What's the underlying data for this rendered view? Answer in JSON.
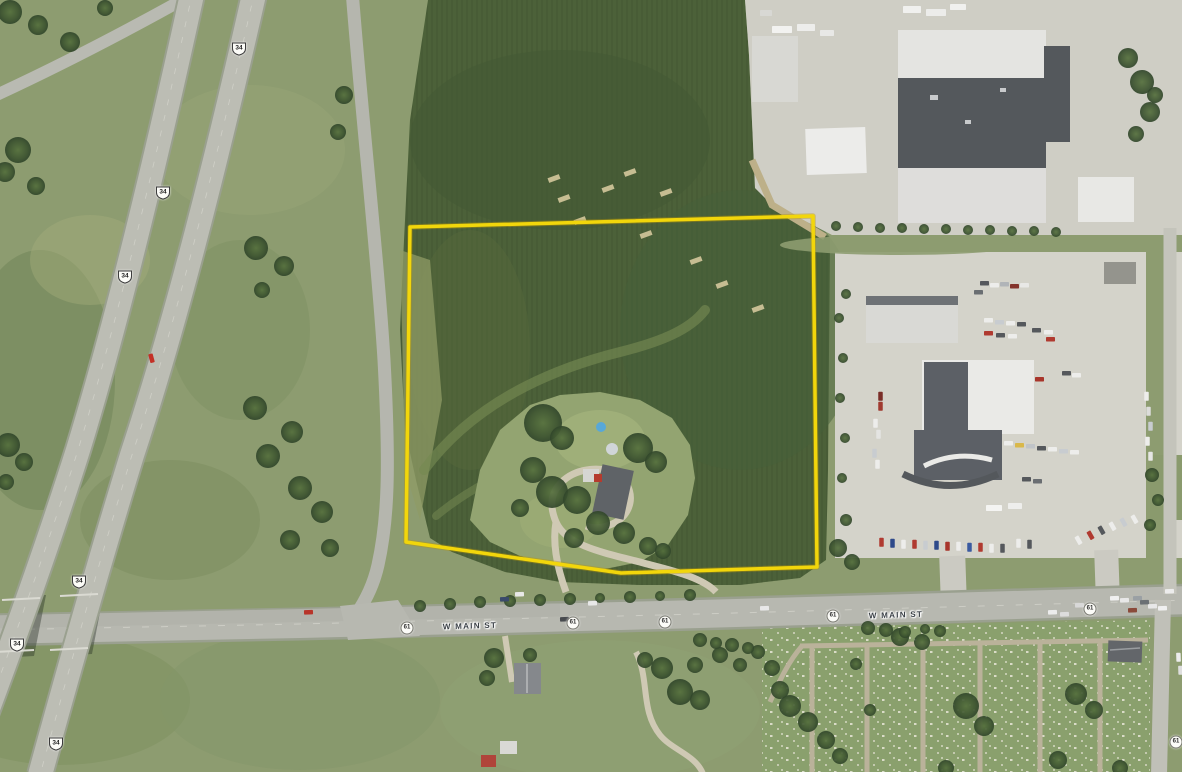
{
  "map": {
    "type": "aerial-imagery-with-parcel-overlay",
    "boundary": {
      "points": "410,227 813,216 817,567 621,573 406,542",
      "color": "#f2d60b"
    },
    "road_labels": [
      {
        "text": "W MAIN ST",
        "x": 470,
        "y": 626
      },
      {
        "text": "W MAIN ST",
        "x": 896,
        "y": 615
      }
    ],
    "us_route_shields": [
      {
        "label": "34",
        "x": 239,
        "y": 49
      },
      {
        "label": "34",
        "x": 163,
        "y": 193
      },
      {
        "label": "34",
        "x": 125,
        "y": 277
      },
      {
        "label": "34",
        "x": 79,
        "y": 582
      },
      {
        "label": "34",
        "x": 17,
        "y": 645
      },
      {
        "label": "34",
        "x": 56,
        "y": 744
      }
    ],
    "circle_route_shields": [
      {
        "label": "61",
        "x": 407,
        "y": 628
      },
      {
        "label": "61",
        "x": 573,
        "y": 623
      },
      {
        "label": "61",
        "x": 665,
        "y": 622
      },
      {
        "label": "61",
        "x": 833,
        "y": 616
      },
      {
        "label": "61",
        "x": 1090,
        "y": 609
      },
      {
        "label": "61",
        "x": 1176,
        "y": 742
      }
    ],
    "colors": {
      "field_dark": "#4c6139",
      "grass": "#8d9c70",
      "pavement": "#cfcec5",
      "road": "#b7b8b0",
      "boundary_yellow": "#f2d60b"
    }
  },
  "scene": {
    "trees": [
      [
        10,
        12,
        12
      ],
      [
        38,
        25,
        10
      ],
      [
        70,
        42,
        10
      ],
      [
        105,
        8,
        8
      ],
      [
        18,
        150,
        13
      ],
      [
        5,
        172,
        10
      ],
      [
        36,
        186,
        9
      ],
      [
        8,
        445,
        12
      ],
      [
        24,
        462,
        9
      ],
      [
        6,
        482,
        8
      ],
      [
        256,
        248,
        12
      ],
      [
        284,
        266,
        10
      ],
      [
        262,
        290,
        8
      ],
      [
        255,
        408,
        12
      ],
      [
        292,
        432,
        11
      ],
      [
        268,
        456,
        12
      ],
      [
        300,
        488,
        12
      ],
      [
        322,
        512,
        11
      ],
      [
        290,
        540,
        10
      ],
      [
        330,
        548,
        9
      ],
      [
        344,
        95,
        9
      ],
      [
        338,
        132,
        8
      ],
      [
        543,
        423,
        19
      ],
      [
        562,
        438,
        12
      ],
      [
        533,
        470,
        13
      ],
      [
        552,
        492,
        16
      ],
      [
        577,
        500,
        14
      ],
      [
        598,
        523,
        12
      ],
      [
        574,
        538,
        10
      ],
      [
        638,
        448,
        15
      ],
      [
        656,
        462,
        11
      ],
      [
        624,
        533,
        11
      ],
      [
        648,
        546,
        9
      ],
      [
        663,
        551,
        8
      ],
      [
        520,
        508,
        9
      ],
      [
        662,
        668,
        11
      ],
      [
        645,
        660,
        8
      ],
      [
        680,
        692,
        13
      ],
      [
        700,
        700,
        10
      ],
      [
        695,
        665,
        8
      ],
      [
        720,
        655,
        8
      ],
      [
        740,
        665,
        7
      ],
      [
        758,
        652,
        7
      ],
      [
        772,
        668,
        8
      ],
      [
        780,
        690,
        9
      ],
      [
        790,
        706,
        11
      ],
      [
        808,
        722,
        10
      ],
      [
        826,
        740,
        9
      ],
      [
        840,
        756,
        8
      ],
      [
        494,
        658,
        10
      ],
      [
        487,
        678,
        8
      ],
      [
        530,
        655,
        7
      ],
      [
        900,
        637,
        9
      ],
      [
        922,
        642,
        8
      ],
      [
        966,
        706,
        13
      ],
      [
        984,
        726,
        10
      ],
      [
        946,
        768,
        8
      ],
      [
        870,
        710,
        6
      ],
      [
        1058,
        760,
        9
      ],
      [
        1076,
        694,
        11
      ],
      [
        1094,
        710,
        9
      ],
      [
        1120,
        768,
        8
      ],
      [
        856,
        664,
        6
      ],
      [
        1128,
        58,
        10
      ],
      [
        1142,
        82,
        12
      ],
      [
        1150,
        112,
        10
      ],
      [
        1136,
        134,
        8
      ],
      [
        1155,
        95,
        8
      ],
      [
        420,
        606,
        6
      ],
      [
        450,
        604,
        6
      ],
      [
        480,
        602,
        6
      ],
      [
        510,
        601,
        6
      ],
      [
        540,
        600,
        6
      ],
      [
        570,
        599,
        6
      ],
      [
        600,
        598,
        5
      ],
      [
        630,
        597,
        6
      ],
      [
        660,
        596,
        5
      ],
      [
        690,
        595,
        6
      ],
      [
        868,
        628,
        7
      ],
      [
        886,
        630,
        7
      ],
      [
        905,
        632,
        6
      ],
      [
        925,
        629,
        5
      ],
      [
        940,
        631,
        6
      ],
      [
        700,
        640,
        7
      ],
      [
        716,
        643,
        6
      ],
      [
        732,
        645,
        7
      ],
      [
        748,
        648,
        6
      ],
      [
        836,
        226,
        5
      ],
      [
        858,
        227,
        5
      ],
      [
        880,
        228,
        5
      ],
      [
        902,
        228,
        5
      ],
      [
        924,
        229,
        5
      ],
      [
        946,
        229,
        5
      ],
      [
        968,
        230,
        5
      ],
      [
        990,
        230,
        5
      ],
      [
        1012,
        231,
        5
      ],
      [
        1034,
        231,
        5
      ],
      [
        1056,
        232,
        5
      ],
      [
        838,
        548,
        9
      ],
      [
        852,
        562,
        8
      ],
      [
        846,
        520,
        6
      ],
      [
        842,
        478,
        5
      ],
      [
        845,
        438,
        5
      ],
      [
        840,
        398,
        5
      ],
      [
        843,
        358,
        5
      ],
      [
        839,
        318,
        5
      ],
      [
        846,
        294,
        5
      ],
      [
        1152,
        475,
        7
      ],
      [
        1158,
        500,
        6
      ],
      [
        1150,
        525,
        6
      ]
    ],
    "buildings": [
      [
        752,
        36,
        46,
        66,
        "#d8d8d3",
        0
      ],
      [
        806,
        128,
        60,
        46,
        "#ececea",
        -2
      ],
      [
        898,
        30,
        148,
        50,
        "#e4e4e1",
        0
      ],
      [
        898,
        78,
        148,
        92,
        "#54585c",
        0
      ],
      [
        898,
        168,
        148,
        55,
        "#dedddb",
        0
      ],
      [
        1044,
        46,
        26,
        96,
        "#54585c",
        0
      ],
      [
        1078,
        177,
        56,
        45,
        "#e8e8e5",
        0
      ],
      [
        866,
        296,
        92,
        47,
        "#d9d9d5",
        0
      ],
      [
        866,
        296,
        92,
        9,
        "#6e7276",
        0
      ],
      [
        922,
        360,
        112,
        74,
        "#eaeae7",
        0
      ],
      [
        924,
        362,
        44,
        70,
        "#5c6066",
        0
      ],
      [
        914,
        430,
        88,
        50,
        "#5c6066",
        0
      ],
      [
        1104,
        262,
        32,
        22,
        "#94948d",
        0
      ],
      [
        1108,
        641,
        34,
        21,
        "#63666a",
        2
      ],
      [
        514,
        663,
        27,
        31,
        "#85888c",
        0
      ],
      [
        500,
        741,
        17,
        13,
        "#d9d9d5",
        0
      ],
      [
        481,
        755,
        15,
        12,
        "#b0443a",
        0
      ],
      [
        597,
        467,
        32,
        50,
        "#5f6367",
        12
      ],
      [
        583,
        469,
        16,
        13,
        "#d6d6d2",
        0
      ],
      [
        594,
        474,
        8,
        8,
        "#b53b2e",
        0
      ]
    ],
    "cars": [
      [
        147,
        356,
        "#c33026",
        75
      ],
      [
        304,
        610,
        "#b8352a",
        -2
      ],
      [
        500,
        597,
        "#3a4a6b",
        -2
      ],
      [
        515,
        592,
        "#e8e8e8",
        -2
      ],
      [
        560,
        617,
        "#474a4e",
        -2
      ],
      [
        588,
        601,
        "#e8e8e8",
        -2
      ],
      [
        760,
        606,
        "#e8e8e8",
        -2
      ],
      [
        1048,
        610,
        "#ececec",
        -2
      ],
      [
        1060,
        612,
        "#dcdcdc",
        -2
      ],
      [
        1075,
        603,
        "#d8d8d8",
        -2
      ],
      [
        1110,
        596,
        "#f0f0f0",
        -2
      ],
      [
        1120,
        598,
        "#e8e8e8",
        -2
      ],
      [
        1133,
        596,
        "#9aa0a4",
        -2
      ],
      [
        1140,
        600,
        "#6b7074",
        -2
      ],
      [
        1148,
        604,
        "#e8e8e8",
        -2
      ],
      [
        1158,
        606,
        "#f0f0f0",
        -2
      ],
      [
        1165,
        589,
        "#ececec",
        -2
      ],
      [
        1128,
        608,
        "#8a4a3a",
        -2
      ],
      [
        1174,
        655,
        "#ececec",
        88
      ],
      [
        1176,
        668,
        "#dedede",
        88
      ],
      [
        772,
        26,
        "#f2f2f0",
        0,
        20,
        7
      ],
      [
        797,
        24,
        "#ededeb",
        0,
        18,
        7
      ],
      [
        820,
        30,
        "#e8e8e6",
        0,
        14,
        6
      ],
      [
        903,
        6,
        "#f0f0ee",
        0,
        18,
        7
      ],
      [
        926,
        9,
        "#ececea",
        0,
        20,
        7
      ],
      [
        950,
        4,
        "#f0f0ee",
        0,
        16,
        6
      ],
      [
        760,
        10,
        "#d8d8d4",
        0,
        12,
        6
      ],
      [
        986,
        505,
        "#f4f4f2",
        0,
        16,
        6
      ],
      [
        1008,
        503,
        "#eeeeec",
        0,
        14,
        6
      ],
      [
        980,
        281,
        "#55585c",
        0
      ],
      [
        990,
        283,
        "#ededeb",
        0
      ],
      [
        1000,
        282,
        "#b0b4b8",
        0
      ],
      [
        1010,
        284,
        "#84342c",
        0
      ],
      [
        1020,
        283,
        "#e8e8e6",
        0
      ],
      [
        974,
        290,
        "#6a6e72",
        0
      ],
      [
        984,
        318,
        "#ededeb",
        0
      ],
      [
        995,
        320,
        "#c8ccd0",
        0
      ],
      [
        1006,
        321,
        "#ededeb",
        0
      ],
      [
        1017,
        322,
        "#55585c",
        0
      ],
      [
        984,
        331,
        "#b03a30",
        0
      ],
      [
        996,
        333,
        "#55585c",
        0
      ],
      [
        1008,
        334,
        "#ededeb",
        0
      ],
      [
        1032,
        328,
        "#55585c",
        0
      ],
      [
        1044,
        330,
        "#ededeb",
        0
      ],
      [
        1046,
        337,
        "#b03a30",
        0
      ],
      [
        1035,
        377,
        "#a8352b",
        0
      ],
      [
        1062,
        371,
        "#55585c",
        0
      ],
      [
        1072,
        373,
        "#ededeb",
        0
      ],
      [
        876,
        394,
        "#7a2e28",
        90
      ],
      [
        876,
        404,
        "#a03a30",
        90
      ],
      [
        871,
        421,
        "#ededeb",
        90
      ],
      [
        874,
        432,
        "#e4e4e2",
        90
      ],
      [
        870,
        451,
        "#c8ccd0",
        90
      ],
      [
        873,
        462,
        "#ededeb",
        90
      ],
      [
        1004,
        441,
        "#ededeb",
        0
      ],
      [
        1015,
        443,
        "#d9b84a",
        0
      ],
      [
        1026,
        444,
        "#c0c4c8",
        0
      ],
      [
        1037,
        446,
        "#55585c",
        0
      ],
      [
        1048,
        447,
        "#ededeb",
        0
      ],
      [
        1059,
        449,
        "#c8ccd0",
        0
      ],
      [
        1070,
        450,
        "#ededeb",
        0
      ],
      [
        1022,
        477,
        "#55585c",
        0
      ],
      [
        1033,
        479,
        "#6a6e72",
        0
      ],
      [
        1142,
        394,
        "#ededeb",
        90
      ],
      [
        1144,
        409,
        "#dcdcda",
        90
      ],
      [
        1146,
        424,
        "#c8ccd0",
        90
      ],
      [
        1143,
        439,
        "#ededeb",
        90
      ],
      [
        1146,
        454,
        "#e6e6e4",
        90
      ],
      [
        877,
        540,
        "#b03a30",
        90
      ],
      [
        888,
        541,
        "#2e4a8a",
        90
      ],
      [
        899,
        542,
        "#ededeb",
        90
      ],
      [
        910,
        542,
        "#b03a30",
        90
      ],
      [
        921,
        543,
        "#c8ccd0",
        90
      ],
      [
        932,
        543,
        "#2e4a8a",
        90
      ],
      [
        943,
        544,
        "#a8352b",
        90
      ],
      [
        954,
        544,
        "#ededeb",
        90
      ],
      [
        965,
        545,
        "#3a5aa0",
        90
      ],
      [
        976,
        545,
        "#b03a30",
        90
      ],
      [
        987,
        546,
        "#ededeb",
        90
      ],
      [
        998,
        546,
        "#55585c",
        90
      ],
      [
        1014,
        541,
        "#ededeb",
        90
      ],
      [
        1025,
        542,
        "#55585c",
        90
      ],
      [
        1074,
        538,
        "#ededeb",
        60
      ],
      [
        1086,
        533,
        "#b03a30",
        60
      ],
      [
        1097,
        528,
        "#55585c",
        60
      ],
      [
        1108,
        524,
        "#ededeb",
        60
      ],
      [
        1119,
        520,
        "#c8ccd0",
        60
      ],
      [
        1130,
        517,
        "#ededeb",
        60
      ]
    ],
    "field_marks": [
      [
        558,
        196
      ],
      [
        574,
        218
      ],
      [
        602,
        186
      ],
      [
        640,
        232
      ],
      [
        548,
        176
      ],
      [
        690,
        258
      ],
      [
        716,
        282
      ],
      [
        752,
        306
      ],
      [
        624,
        170
      ],
      [
        660,
        190
      ]
    ],
    "dots": [
      [
        601,
        427,
        5,
        "#58a8d8"
      ],
      [
        612,
        449,
        6,
        "#d0d5d8"
      ]
    ]
  }
}
